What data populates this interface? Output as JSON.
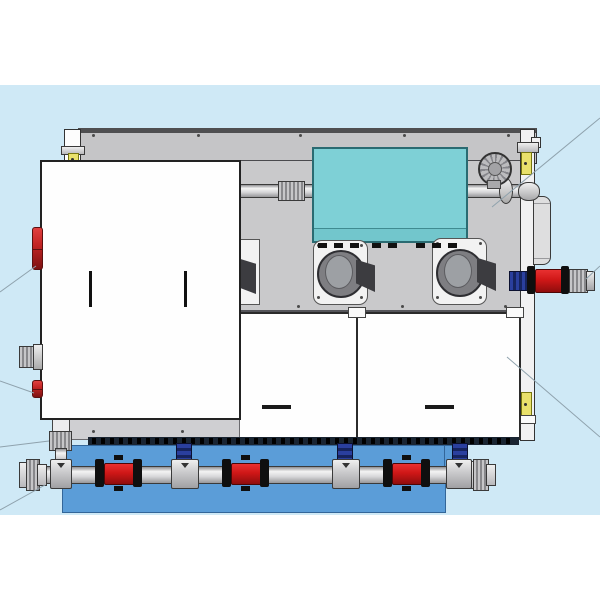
{
  "scene": {
    "width": 600,
    "height": 600,
    "description": "CAD-style front elevation of an industrial pump/filtration skid unit with piping manifold",
    "background_band": {
      "y": 85,
      "height": 430
    }
  },
  "palette": {
    "bg_white": "#ffffff",
    "bg_blue": "#cfe9f6",
    "rail_gray": "#c5c5c7",
    "rail_dark": "#4f4f51",
    "panel_gray": "#c9c9cb",
    "side_strip": "#f1f1f2",
    "teal": "#7ed0d6",
    "teal_dark": "#72c6cc",
    "teal_border": "#2a6b72",
    "door_white": "#fefefe",
    "door_border": "#2b2b2b",
    "handle_black": "#1a1a1a",
    "fan_plate": "#f2f2f2",
    "fan_outer": "#7e7e82",
    "fan_inner": "#9da0a4",
    "bracket_dark": "#3c3c40",
    "base_gray": "#cfcfd2",
    "grate_dark": "#1a2532",
    "tank_blue": "#5b9dd8",
    "pipe_silver": "#d7d7d9",
    "pipe_border": "#3a3a3a",
    "valve_red": "#cf1717",
    "valve_dark": "#0f0f0f",
    "conn_blue": "#2a3f9e",
    "conn_blue_dark": "#16245f",
    "label_yellow": "#e9e16b",
    "label_border": "#77770f",
    "red_part": "#c32525",
    "leader": "#8fa2ad"
  },
  "screws": [
    [
      93,
      135
    ],
    [
      198,
      135
    ],
    [
      300,
      135
    ],
    [
      404,
      135
    ],
    [
      508,
      135
    ],
    [
      298,
      306
    ],
    [
      402,
      306
    ],
    [
      505,
      306
    ],
    [
      93,
      431
    ],
    [
      182,
      431
    ],
    [
      318,
      245
    ],
    [
      361,
      245
    ],
    [
      318,
      297
    ],
    [
      361,
      297
    ],
    [
      437,
      243
    ],
    [
      480,
      243
    ],
    [
      437,
      297
    ],
    [
      480,
      297
    ]
  ],
  "louvers": {
    "y": 243,
    "w": 9,
    "h": 5,
    "xs": [
      318,
      334,
      350,
      372,
      388,
      416,
      432,
      448
    ]
  },
  "grate_slots": {
    "x_start": 92,
    "x_end": 512,
    "step": 9
  },
  "clips_x": [
    348,
    506
  ],
  "piping": {
    "tees": [
      {
        "x": 50,
        "w": 20
      },
      {
        "x": 171,
        "w": 26
      },
      {
        "x": 332,
        "w": 26
      },
      {
        "x": 446,
        "w": 24
      }
    ],
    "butterfly_valves_x": [
      95,
      222,
      383
    ],
    "blue_connectors_x": [
      176,
      337,
      452
    ]
  },
  "leader_lines": [
    [
      0,
      292,
      36,
      266
    ],
    [
      0,
      381,
      34,
      393
    ],
    [
      0,
      447,
      49,
      441
    ],
    [
      0,
      510,
      45,
      485
    ],
    [
      600,
      118,
      492,
      207
    ],
    [
      600,
      266,
      586,
      279
    ],
    [
      507,
      357,
      600,
      437
    ]
  ]
}
